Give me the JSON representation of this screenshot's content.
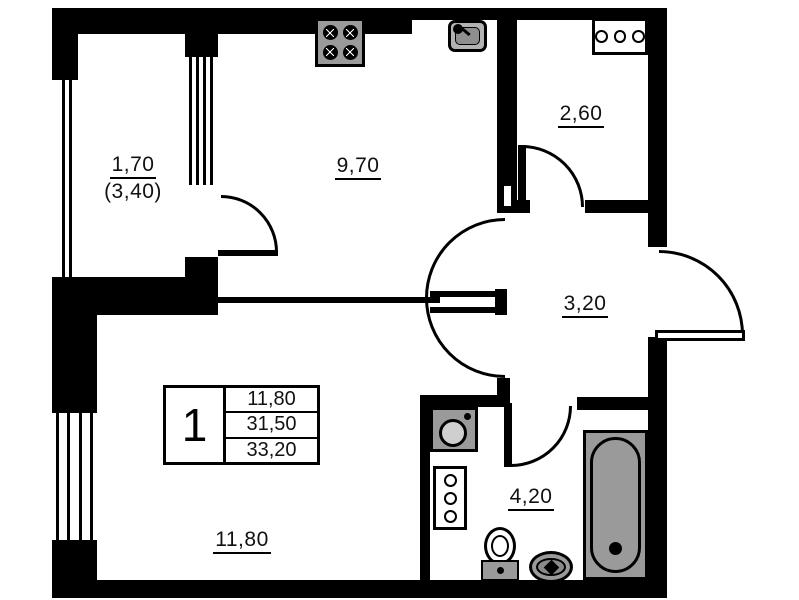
{
  "plan_title": "apartment-floor-plan",
  "rooms": {
    "balcony": {
      "area": "1,70",
      "area_with_coefficient": "(3,40)"
    },
    "kitchen": {
      "area": "9,70"
    },
    "closet": {
      "area": "2,60"
    },
    "hallway": {
      "area": "3,20"
    },
    "bathroom": {
      "area": "4,20"
    },
    "living_room": {
      "area": "11,80"
    }
  },
  "stamp": {
    "rooms_count": "1",
    "rows": [
      "11,80",
      "31,50",
      "33,20"
    ]
  },
  "icons": {
    "stove": "stove-icon",
    "kitchen_sink": "sink-icon",
    "vent_grille_horizontal": "vent-grille-icon",
    "washing_machine": "washing-machine-icon",
    "towel_rail_panel": "towel-rail-icon",
    "toilet": "toilet-icon",
    "round_floor_sink": "round-sink-icon",
    "bathtub": "bathtub-icon"
  },
  "colors": {
    "wall": "#000000",
    "background": "#ffffff",
    "fixture_gray": "#9a9a9a"
  }
}
